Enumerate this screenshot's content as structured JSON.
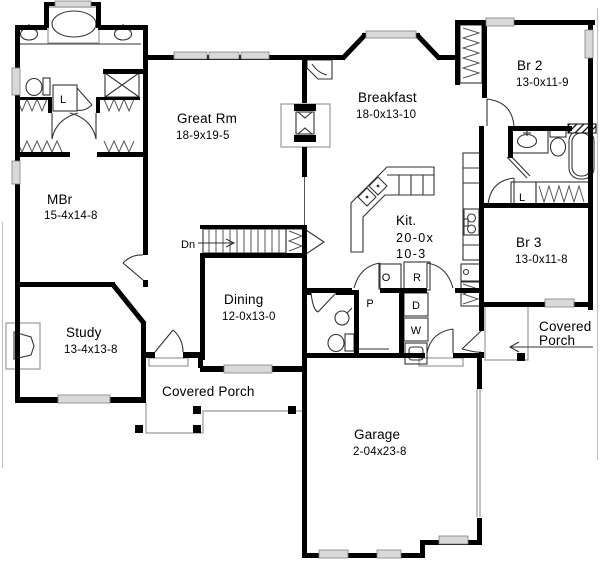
{
  "plan": {
    "rooms": [
      {
        "id": "mbr",
        "name": "MBr",
        "dims": "15-4x14-8"
      },
      {
        "id": "great-room",
        "name": "Great Rm",
        "dims": "18-9x19-5"
      },
      {
        "id": "breakfast",
        "name": "Breakfast",
        "dims": "18-0x13-10"
      },
      {
        "id": "br2",
        "name": "Br 2",
        "dims": "13-0x11-9"
      },
      {
        "id": "kitchen",
        "name": "Kit.",
        "dims_line1": "20-0x",
        "dims_line2": "10-3"
      },
      {
        "id": "br3",
        "name": "Br 3",
        "dims": "13-0x11-8"
      },
      {
        "id": "dining",
        "name": "Dining",
        "dims": "12-0x13-0"
      },
      {
        "id": "study",
        "name": "Study",
        "dims": "13-4x13-8"
      },
      {
        "id": "garage",
        "name": "Garage",
        "dims": "2-04x23-8"
      }
    ],
    "labels": {
      "stairs_down": "Dn",
      "linen_master": "L",
      "linen_hall": "L",
      "oven": "O",
      "range": "R",
      "pantry": "P",
      "dryer": "D",
      "washer": "W",
      "front_porch": "Covered Porch",
      "side_porch_line1": "Covered",
      "side_porch_line2": "Porch"
    },
    "colors": {
      "wall": "#000000",
      "window_fill": "#d9d9d9",
      "background": "#ffffff",
      "thin_line": "#555555"
    }
  }
}
